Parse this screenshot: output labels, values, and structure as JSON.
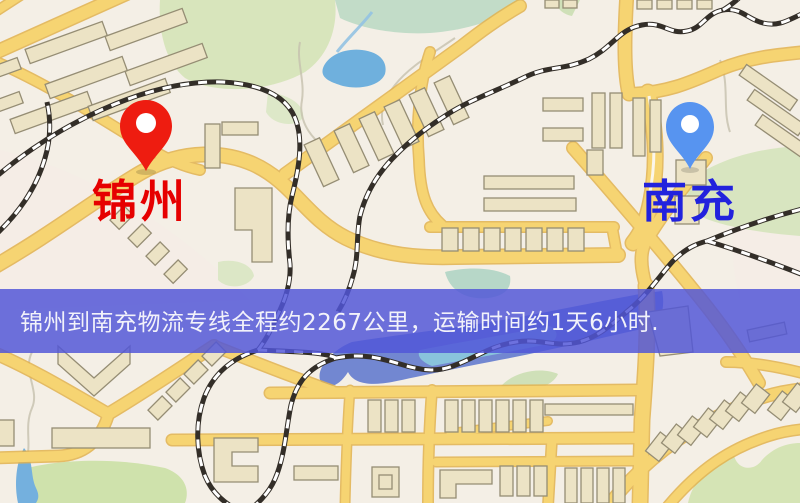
{
  "banner": {
    "text": "锦州到南充物流专线全程约2267公里，运输时间约1天6小时.",
    "bg_color": "#5156d8",
    "text_color": "#f2f2fa"
  },
  "origin": {
    "name": "锦州",
    "label_color": "#e60000",
    "pin_color": "#ee1c10"
  },
  "destination": {
    "name": "南充",
    "label_color": "#2222dd",
    "pin_color": "#5794f0"
  },
  "route_info": {
    "distance_text": "2267公里",
    "duration_text": "1天6小时"
  },
  "map_colors": {
    "road": "#f6d472",
    "water": "#6fb0dd",
    "river": "#5b74cc",
    "park": "#d8e5bc",
    "building": "#ece3c5",
    "railway": "#332e28"
  }
}
